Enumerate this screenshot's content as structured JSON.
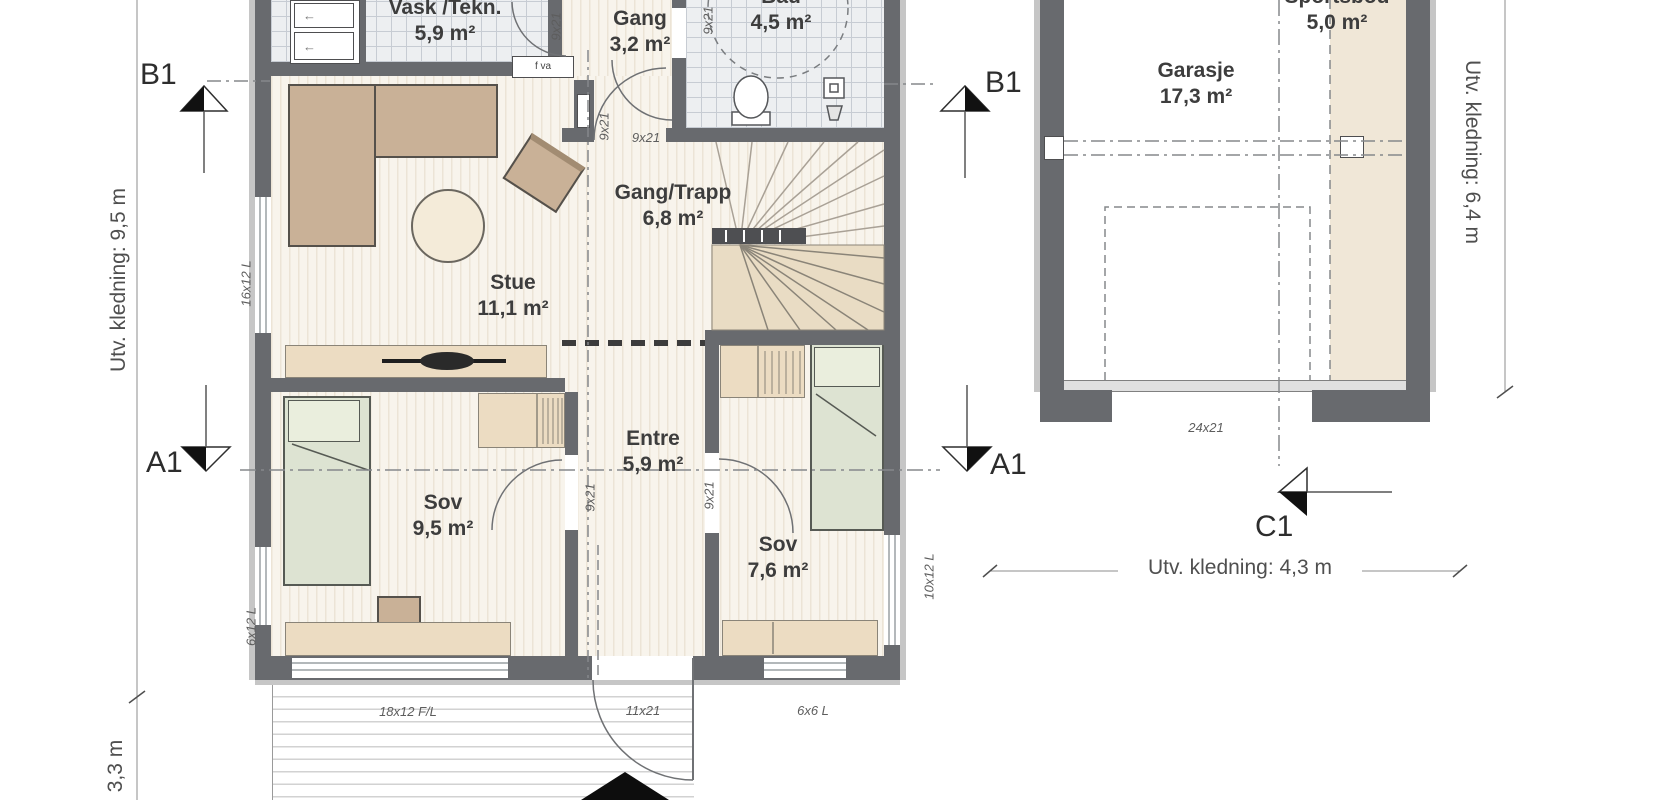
{
  "rooms": {
    "vask": {
      "name": "Vask /Tekn.",
      "area": "5,9 m²"
    },
    "gang": {
      "name": "Gang",
      "area": "3,2 m²"
    },
    "bad": {
      "name": "Bad",
      "area": "4,5 m²"
    },
    "gang_trapp": {
      "name": "Gang/Trapp",
      "area": "6,8 m²"
    },
    "stue": {
      "name": "Stue",
      "area": "11,1 m²"
    },
    "entre": {
      "name": "Entre",
      "area": "5,9 m²"
    },
    "sov_9": {
      "name": "Sov",
      "area": "9,5 m²"
    },
    "sov_7": {
      "name": "Sov",
      "area": "7,6 m²"
    },
    "garasje": {
      "name": "Garasje",
      "area": "17,3 m²"
    },
    "sportsbod": {
      "name": "Sportsbod",
      "area": "5,0 m²"
    }
  },
  "section_markers": {
    "b1": "B1",
    "a1": "A1",
    "c1": "C1"
  },
  "dimensions": {
    "house_side": "Utv. kledning: 9,5 m",
    "porch_depth": "3,3 m",
    "garage_side": "Utv. kledning: 6,4 m",
    "garage_front": "Utv. kledning: 4,3 m"
  },
  "openings": {
    "standard_door": "9x21",
    "entrance_door": "11x21",
    "garage_door": "24x21",
    "window_stue_left": "16x12 L",
    "window_sov_left": "6x12 L",
    "window_sov_front": "18x12 F/L",
    "window_sov2_front": "6x6 L",
    "window_sov2_side": "10x12 L",
    "tech_cabinet": "f va"
  },
  "colors": {
    "wall": "#686a6e",
    "furniture_tan": "#c9b197",
    "furniture_light": "#ecdcc2",
    "bed_green": "#dde3d2",
    "tile": "#edeff1",
    "wood": "#f8f4ec"
  }
}
